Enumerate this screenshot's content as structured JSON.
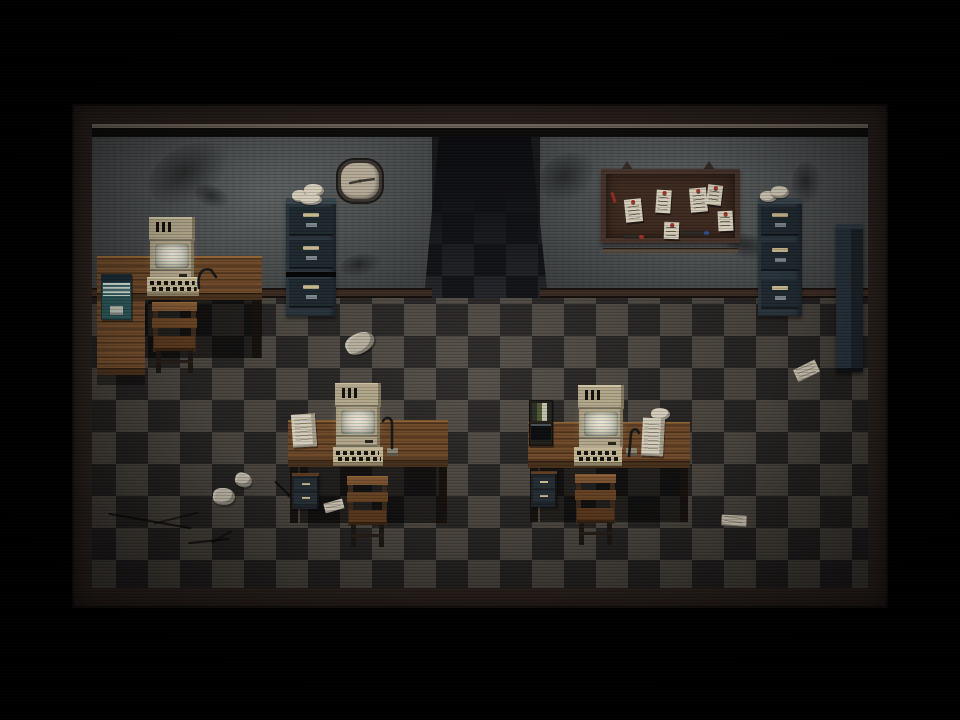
{
  "scene": {
    "name": "retro-office-room",
    "style": "dark top-down pixel-art office with CRT scanline and vignette post-effects",
    "visible_text": "none",
    "objects": [
      "wall-clock",
      "bulletin-board-with-notes",
      "filing-cabinet-left",
      "filing-cabinet-right",
      "tall-locker",
      "dark-hallway-opening",
      "l-shaped-desk-left",
      "desk-middle",
      "desk-right",
      "crt-computer x3",
      "keyboard x3",
      "desk-lamp x3",
      "wooden-chair x3",
      "under-desk-drawer-unit x2",
      "paper-stacks",
      "scattered-paper-scraps",
      "floor-cracks",
      "wall-stains"
    ]
  },
  "palette": {
    "frame": "#2a211d",
    "ceil": "#6e655c",
    "wall": "#565a5b",
    "base": "#3c2b23",
    "tileLight": "#4f4942",
    "tileDark": "#262322",
    "wood": "#6f4a2a",
    "woodHi": "#8f6434",
    "woodLo": "#47301a",
    "cabinet": "#2a353d",
    "cabface": "#1f2930",
    "handle": "#c7b78f",
    "beige": "#b2a78b",
    "kb": "#c3b795",
    "screen": "#f2efe0",
    "paper": "#d3ccba",
    "boardFrame": "#46332a",
    "boardIn": "#3e2b21",
    "pin": "#a23326",
    "markerRed": "#9e2f23",
    "markerBlue": "#2e4f8e",
    "clockRim": "#3b3631",
    "clockFace": "#b5aa97",
    "teal": "#2c5658",
    "chair": "#7a5230"
  },
  "clock": {
    "minute_transform": "rotate(82)",
    "hour_transform": "rotate(258)"
  },
  "board_notes": [
    {
      "x": 19,
      "y": 25,
      "w": 17,
      "h": 23,
      "rot": -6
    },
    {
      "x": 50,
      "y": 16,
      "w": 15,
      "h": 23,
      "rot": 4
    },
    {
      "x": 84,
      "y": 14,
      "w": 17,
      "h": 24,
      "rot": -5
    },
    {
      "x": 101,
      "y": 11,
      "w": 15,
      "h": 20,
      "rot": 7
    },
    {
      "x": 58,
      "y": 48,
      "w": 15,
      "h": 17,
      "rot": 2
    },
    {
      "x": 112,
      "y": 37,
      "w": 15,
      "h": 20,
      "rot": -3
    }
  ],
  "board_markers": [
    {
      "x": 18,
      "y": 66,
      "w": 19,
      "type": "red"
    },
    {
      "x": 75,
      "y": 62,
      "w": 27,
      "type": "blue"
    }
  ],
  "wall_stains": [
    {
      "x": 54,
      "y": 22,
      "w": 86,
      "h": 54,
      "rot": -28
    },
    {
      "x": 102,
      "y": 62,
      "w": 36,
      "h": 22,
      "rot": 20
    },
    {
      "x": 446,
      "y": 30,
      "w": 60,
      "h": 46,
      "rot": -24
    },
    {
      "x": 248,
      "y": 130,
      "w": 42,
      "h": 22,
      "rot": -10
    },
    {
      "x": 634,
      "y": 110,
      "w": 44,
      "h": 26,
      "rot": 12
    },
    {
      "x": 700,
      "y": 38,
      "w": 30,
      "h": 42,
      "rot": 0
    }
  ],
  "floor_papers": [
    {
      "x": 253,
      "y": 209,
      "w": 30,
      "h": 20,
      "rot": -28,
      "type": "crumpled"
    },
    {
      "x": 701,
      "y": 239,
      "w": 26,
      "h": 16,
      "rot": -20,
      "type": "flat"
    },
    {
      "x": 121,
      "y": 364,
      "w": 22,
      "h": 17,
      "rot": 0,
      "type": "crumpled"
    },
    {
      "x": 143,
      "y": 349,
      "w": 17,
      "h": 14,
      "rot": 15,
      "type": "crumpled"
    },
    {
      "x": 628,
      "y": 390,
      "w": 27,
      "h": 13,
      "rot": 8,
      "type": "flat"
    },
    {
      "x": 231,
      "y": 376,
      "w": 21,
      "h": 12,
      "rot": -10,
      "type": "flat"
    }
  ],
  "floor_cracks": [
    {
      "x": 16,
      "y": 396,
      "w": 84,
      "rot": 10
    },
    {
      "x": 178,
      "y": 368,
      "w": 34,
      "rot": 44
    },
    {
      "x": 96,
      "y": 416,
      "w": 42,
      "rot": -6
    }
  ]
}
